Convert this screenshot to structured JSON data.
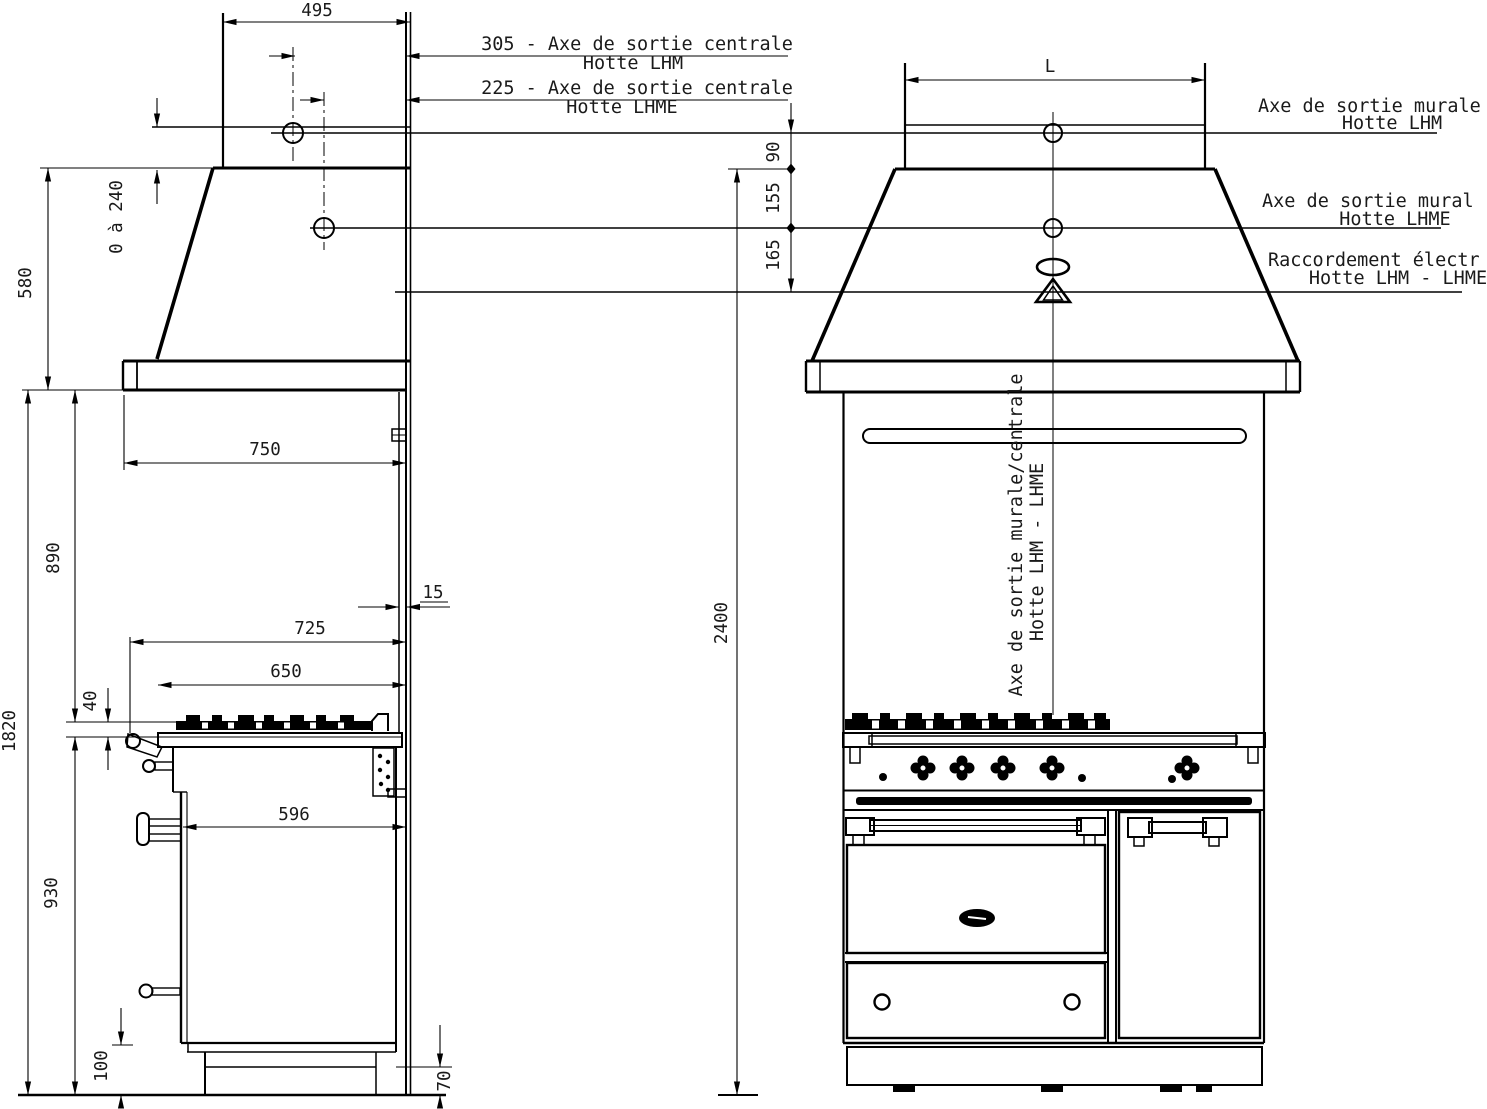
{
  "colors": {
    "line": "#000000",
    "text": "#1a1a1a",
    "background": "#ffffff"
  },
  "labels": {
    "dim_495": "495",
    "axe_centrale_lhm_line1": "305 - Axe de sortie centrale",
    "axe_centrale_lhm_line2": "Hotte LHM",
    "axe_centrale_lhme_line1": "225 - Axe de sortie centrale",
    "axe_centrale_lhme_line2": "Hotte LHME",
    "dim_0_240": "0 à 240",
    "dim_580": "580",
    "dim_L": "L",
    "dim_90": "90",
    "dim_155": "155",
    "dim_165": "165",
    "axe_murale_lhm_line1": "Axe de sortie murale",
    "axe_murale_lhm_line2": "Hotte LHM",
    "axe_murale_lhme_line1": "Axe de sortie mural",
    "axe_murale_lhme_line2": "Hotte LHME",
    "raccordement_line1": "Raccordement électr",
    "raccordement_line2": "Hotte LHM - LHME",
    "axe_sortie_centre_line1": "Axe de sortie murale/centrale",
    "axe_sortie_centre_line2": "Hotte LHM - LHME",
    "dim_750": "750",
    "dim_890": "890",
    "dim_15": "15",
    "dim_725": "725",
    "dim_650": "650",
    "dim_40": "40",
    "dim_1820": "1820",
    "dim_596": "596",
    "dim_930": "930",
    "dim_100": "100",
    "dim_70": "70",
    "dim_2400": "2400"
  }
}
